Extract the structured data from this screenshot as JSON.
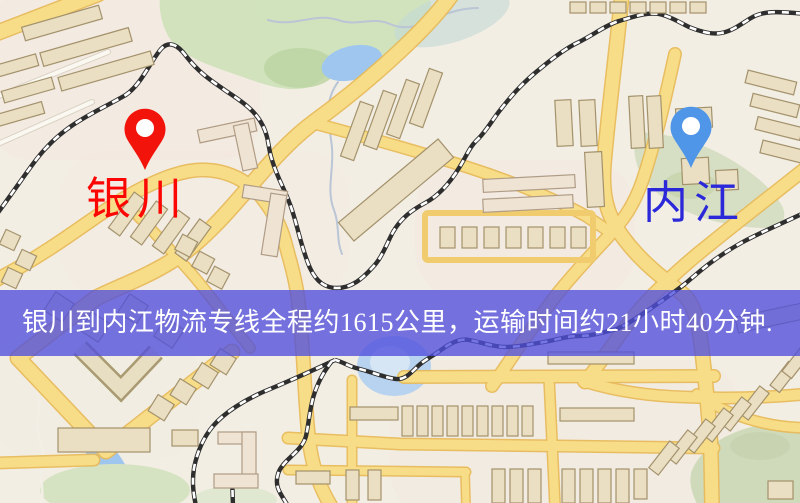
{
  "origin": {
    "label": "银川",
    "icon": "map-pin",
    "pin_color": "#f2130a",
    "label_color": "#fb0603"
  },
  "destination": {
    "label": "内江",
    "icon": "map-pin",
    "pin_color": "#4f96e8",
    "label_color": "#2a28d8"
  },
  "banner": {
    "text": "银川到内江物流专线全程约1615公里，运输时间约21小时40分钟.",
    "background": "rgba(80,78,220,0.78)",
    "text_color": "#ffffff"
  }
}
